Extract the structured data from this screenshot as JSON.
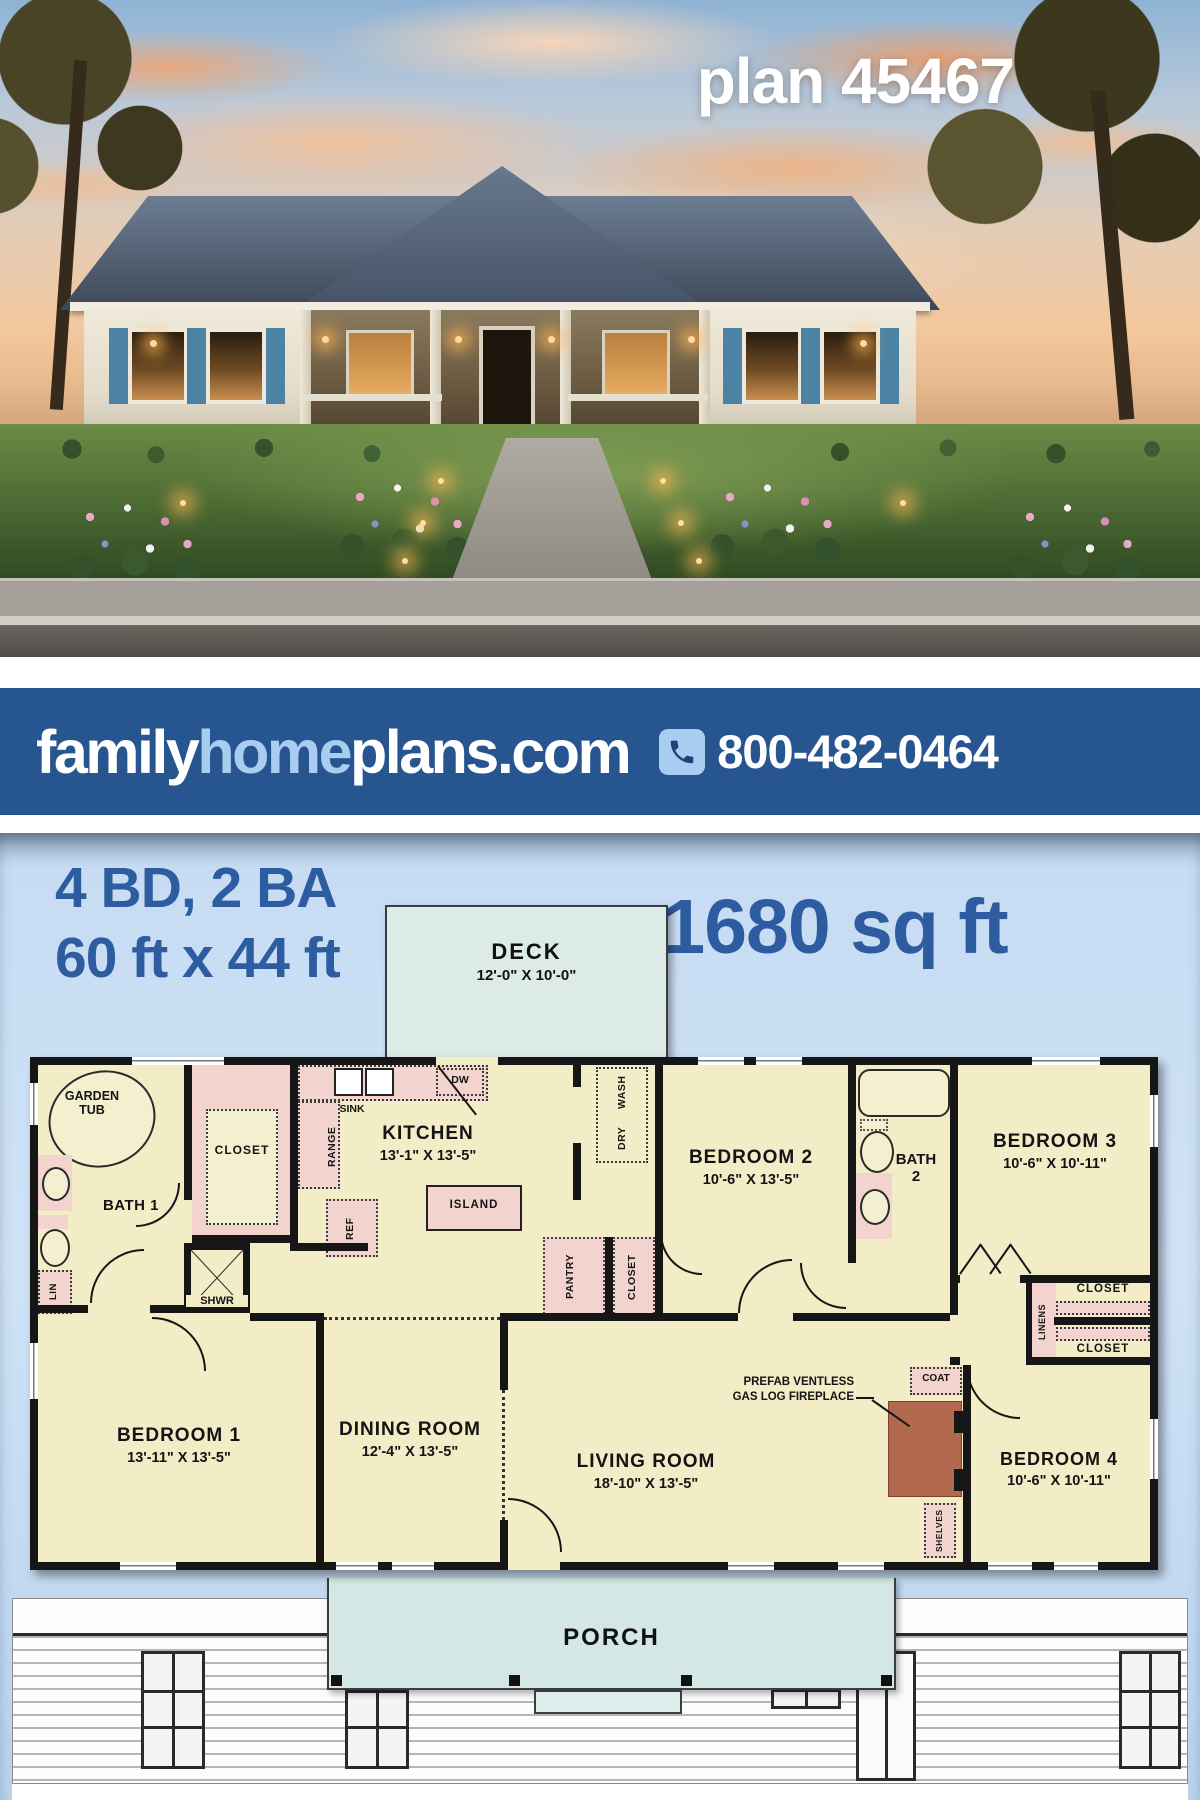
{
  "photo": {
    "plan_label": "plan 45467"
  },
  "banner": {
    "brand": {
      "family": "family",
      "home": "home",
      "plans": "plans.com"
    },
    "phone": "800-482-0464",
    "colors": {
      "background": "#275590",
      "accent": "#a9cdf1"
    }
  },
  "stats": {
    "bed_bath": "4 BD, 2 BA",
    "footprint": "60 ft x 44 ft",
    "area": "1680 sq ft",
    "text_color": "#2d5da0"
  },
  "plan": {
    "deck": {
      "name": "DECK",
      "dims": "12'-0\" X 10'-0\""
    },
    "porch": "PORCH",
    "rooms": {
      "kitchen": {
        "name": "KITCHEN",
        "dims": "13'-1\" X 13'-5\""
      },
      "bedroom2": {
        "name": "BEDROOM 2",
        "dims": "10'-6\" X 13'-5\""
      },
      "bedroom3": {
        "name": "BEDROOM 3",
        "dims": "10'-6\" X 10'-11\""
      },
      "bedroom1": {
        "name": "BEDROOM 1",
        "dims": "13'-11\" X 13'-5\""
      },
      "bedroom4": {
        "name": "BEDROOM 4",
        "dims": "10'-6\" X 10'-11\""
      },
      "dining": {
        "name": "DINING ROOM",
        "dims": "12'-4\" X 13'-5\""
      },
      "living": {
        "name": "LIVING ROOM",
        "dims": "18'-10\" X 13'-5\""
      },
      "bath1": {
        "name": "BATH 1"
      },
      "bath2_line1": "BATH",
      "bath2_line2": "2"
    },
    "fixtures": {
      "garden_tub": "GARDEN TUB",
      "closet_walkin": "CLOSET",
      "sink": "SINK",
      "dw": "DW",
      "range": "RANGE",
      "ref": "REF",
      "island": "ISLAND",
      "wash": "WASH",
      "dry": "DRY",
      "pantry": "PANTRY",
      "closet_hall": "CLOSET",
      "lin": "LIN",
      "shwr": "SHWR",
      "linens": "LINENS",
      "closet_b3": "CLOSET",
      "closet_b4": "CLOSET",
      "coat": "COAT",
      "shelves": "SHELVES",
      "fireplace_line1": "PREFAB VENTLESS",
      "fireplace_line2": "GAS LOG FIREPLACE"
    }
  }
}
